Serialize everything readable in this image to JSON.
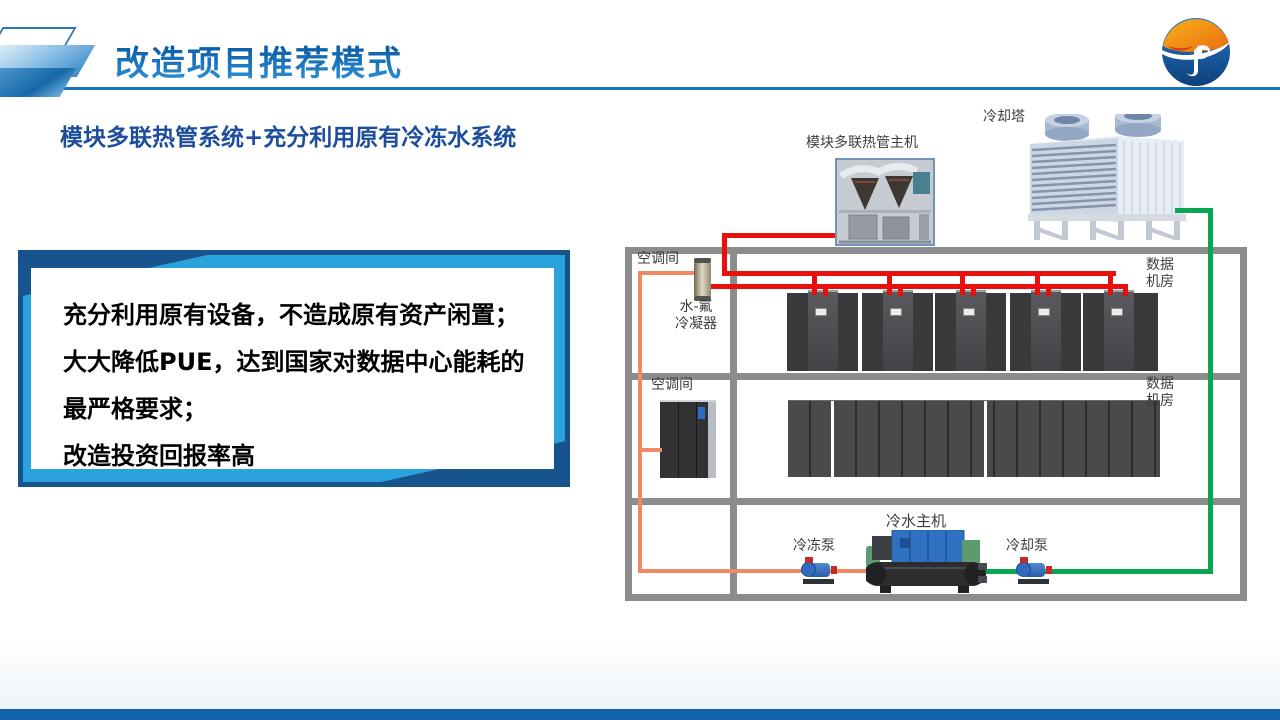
{
  "slide": {
    "title": "改造项目推荐模式",
    "subtitle": "模块多联热管系统+充分利用原有冷冻水系统",
    "logo_name": "jp-globe-logo",
    "accent_blue": "#1a72b8",
    "footer_bar_color": "#1263ac"
  },
  "info_box": {
    "border_color": "#17548e",
    "accent_color": "#2aa2db",
    "lines": [
      "充分利用原有设备，不造成原有资产闲置；",
      "大大降低PUE，达到国家对数据中心能耗的",
      "最严格要求；",
      "改造投资回报率高"
    ]
  },
  "diagram": {
    "labels": {
      "cooling_tower": "冷却塔",
      "heat_pipe_unit": "模块多联热管主机",
      "ac_room_1": "空调间",
      "data_room_1": "数据\n机房",
      "condenser": "水-氟\n冷凝器",
      "ac_room_2": "空调间",
      "data_room_2": "数据\n机房",
      "chiller": "冷水主机",
      "chilled_pump": "冷冻泵",
      "cooling_pump": "冷却泵"
    },
    "colors": {
      "refrigerant_line": "#e8100c",
      "chilled_water_line": "#ef8a64",
      "cooling_water_line": "#0aa654",
      "room_frame": "#8c8c8c"
    },
    "counts": {
      "row1_crac_groups": 5,
      "row2_rack_columns": 16
    }
  }
}
